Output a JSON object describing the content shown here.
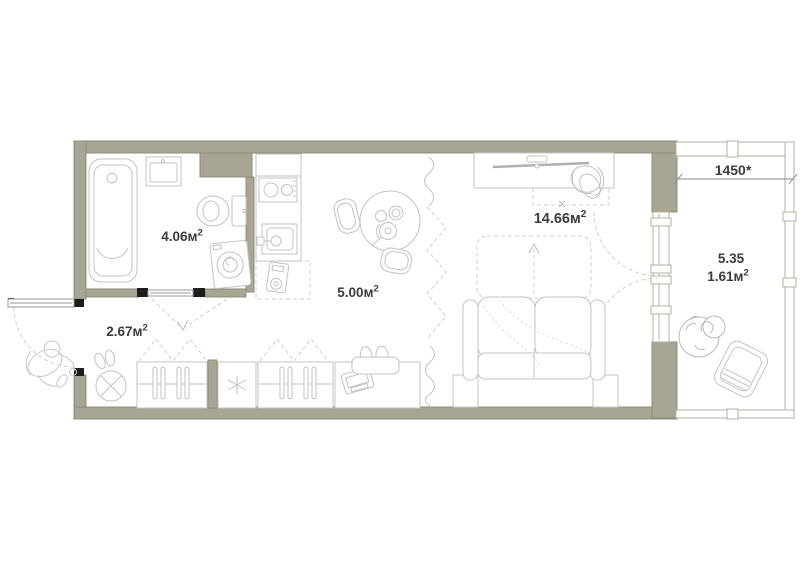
{
  "plan": {
    "type": "apartment-floor-plan",
    "rooms": {
      "bathroom": {
        "area": "4.06м",
        "sup": "2"
      },
      "hallway": {
        "area": "2.67м",
        "sup": "2"
      },
      "kitchen": {
        "area": "5.00м",
        "sup": "2"
      },
      "living_room": {
        "area": "14.66м",
        "sup": "2"
      },
      "balcony": {
        "area_full": "5.35",
        "area_reduced": "1.61м",
        "sup": "2"
      }
    },
    "dimension": {
      "balcony_width": "1450*"
    },
    "colors": {
      "wall_fill": "#a9a593",
      "wall_edge": "#908c7c",
      "window_line": "#b3b0a1",
      "furniture_line": "#c3c3c3",
      "dashed_line": "#cfcfcf",
      "label": "#3c3c3c",
      "wall_cap": "#1d1d1b",
      "dimension_line": "#8a8a8a"
    }
  }
}
